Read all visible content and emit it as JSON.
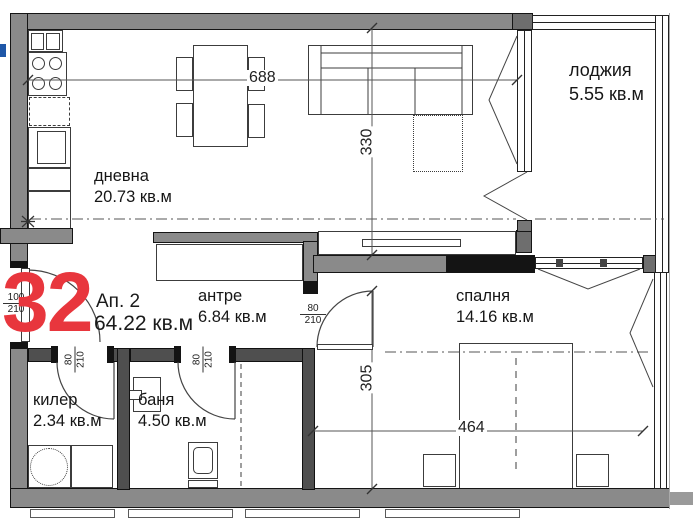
{
  "apartment": {
    "number": "32",
    "label": "Ап. 2",
    "area": "64.22 кв.м"
  },
  "rooms": {
    "living": {
      "name": "дневна",
      "area": "20.73 кв.м"
    },
    "hall": {
      "name": "антре",
      "area": "6.84 кв.м"
    },
    "bedroom": {
      "name": "спалня",
      "area": "14.16 кв.м"
    },
    "loggia": {
      "name": "лоджия",
      "area": "5.55 кв.м"
    },
    "storage": {
      "name": "килер",
      "area": "2.34 кв.м"
    },
    "bath": {
      "name": "баня",
      "area": "4.50 кв.м"
    }
  },
  "dimensions": {
    "overall_width": "688",
    "living_depth": "330",
    "bedroom_depth": "305",
    "bedroom_width": "464"
  },
  "doors": {
    "entrance": {
      "num": "100",
      "den": "210"
    },
    "storage": {
      "num": "80",
      "den": "210"
    },
    "bath": {
      "num": "80",
      "den": "210"
    },
    "bedroom": {
      "num": "80",
      "den": "210"
    }
  },
  "colors": {
    "wall_gray": "#8a8a8a",
    "wall_dark": "#4f4f4f",
    "wall_black": "#141414",
    "apartment_number_red": "#e8363d",
    "corner_mark_blue": "#1f57a8"
  }
}
